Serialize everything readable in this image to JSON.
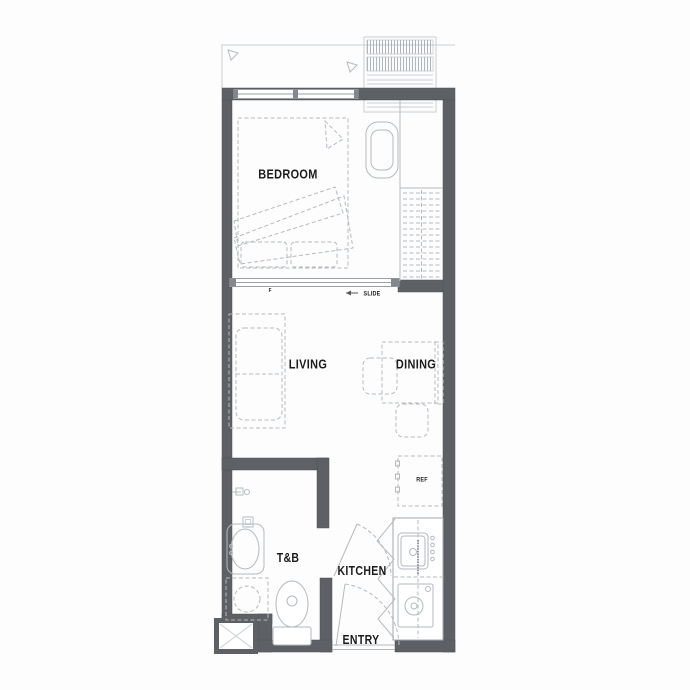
{
  "colors": {
    "wall": "#5d6165",
    "drawing_line": "#b2bac0",
    "label_text": "#1c1c1c",
    "background": "#ffffff"
  },
  "rooms": {
    "bedroom": {
      "label": "BEDROOM"
    },
    "living": {
      "label": "LIVING"
    },
    "dining": {
      "label": "DINING"
    },
    "toilet_bath": {
      "label": "T&B"
    },
    "kitchen": {
      "label": "KITCHEN"
    },
    "entry": {
      "label": "ENTRY"
    }
  },
  "annotations": {
    "refrigerator": "REF",
    "slide": "SLIDE",
    "partition_mark": "F"
  }
}
